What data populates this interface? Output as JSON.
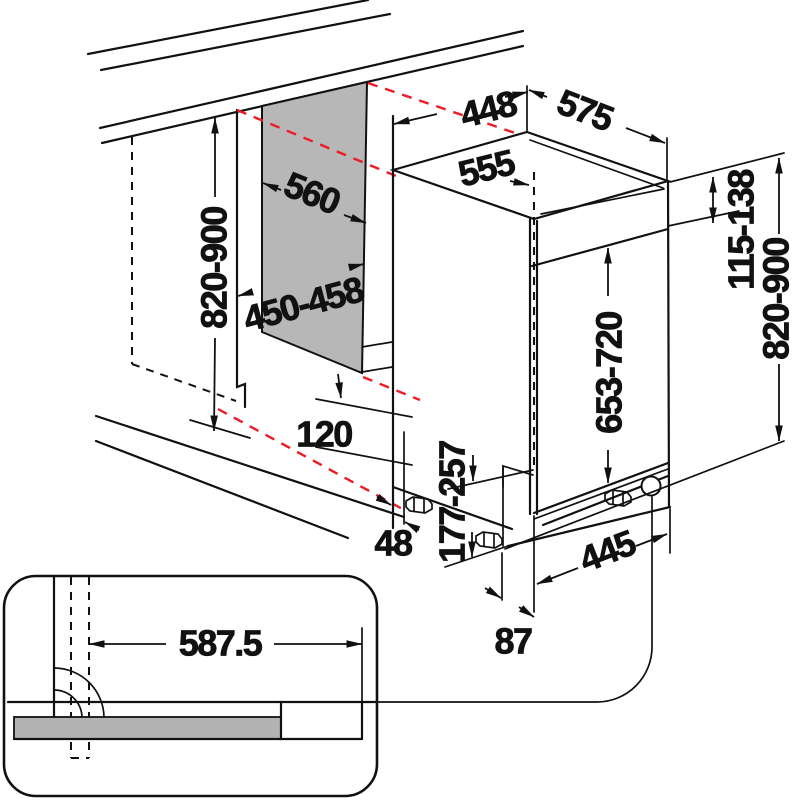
{
  "diagram": {
    "kind": "built-in appliance installation drawing",
    "unit": "mm",
    "colors": {
      "line": "#111111",
      "niche_panel_gray": "#b7b7b7",
      "door_bar_gray": "#b3b3b3",
      "projection_red": "#ed1c24",
      "background": "#ffffff"
    }
  },
  "labels": {
    "niche_height": "820-900",
    "niche_depth": "560",
    "niche_width": "450-458",
    "appliance_width": "448",
    "appliance_depth_total": "575",
    "appliance_depth_body": "555",
    "top_adjustment": "115-138",
    "appliance_height": "820-900",
    "door_height": "653-720",
    "plinth_height": "177-257",
    "plinth_recess": "120",
    "side_clearance": "48",
    "base_depth": "445",
    "foot_setback": "87",
    "door_panel_width": "587.5"
  }
}
